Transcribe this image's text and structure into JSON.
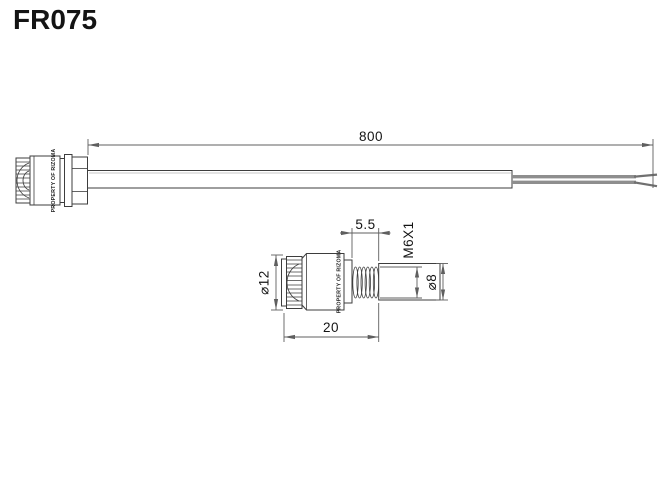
{
  "title": "FR075",
  "views": {
    "top": {
      "name": "full-length indicator with cable",
      "engraving": "PROPERTY OF RIZOMA",
      "dims": {
        "cable_length": "800"
      }
    },
    "detail": {
      "name": "indicator head detail",
      "engraving": "PROPERTY OF RIZOMA",
      "dims": {
        "thread_length": "5.5",
        "thread_spec": "M6X1",
        "lens_diameter": "⌀12",
        "sleeve_diameter": "⌀8",
        "body_length": "20"
      }
    }
  },
  "colors": {
    "background": "#ffffff",
    "line": "#3d3d3d",
    "dimension": "#5f5f5f",
    "cable": "#8e8e8e",
    "text": "#141414"
  }
}
